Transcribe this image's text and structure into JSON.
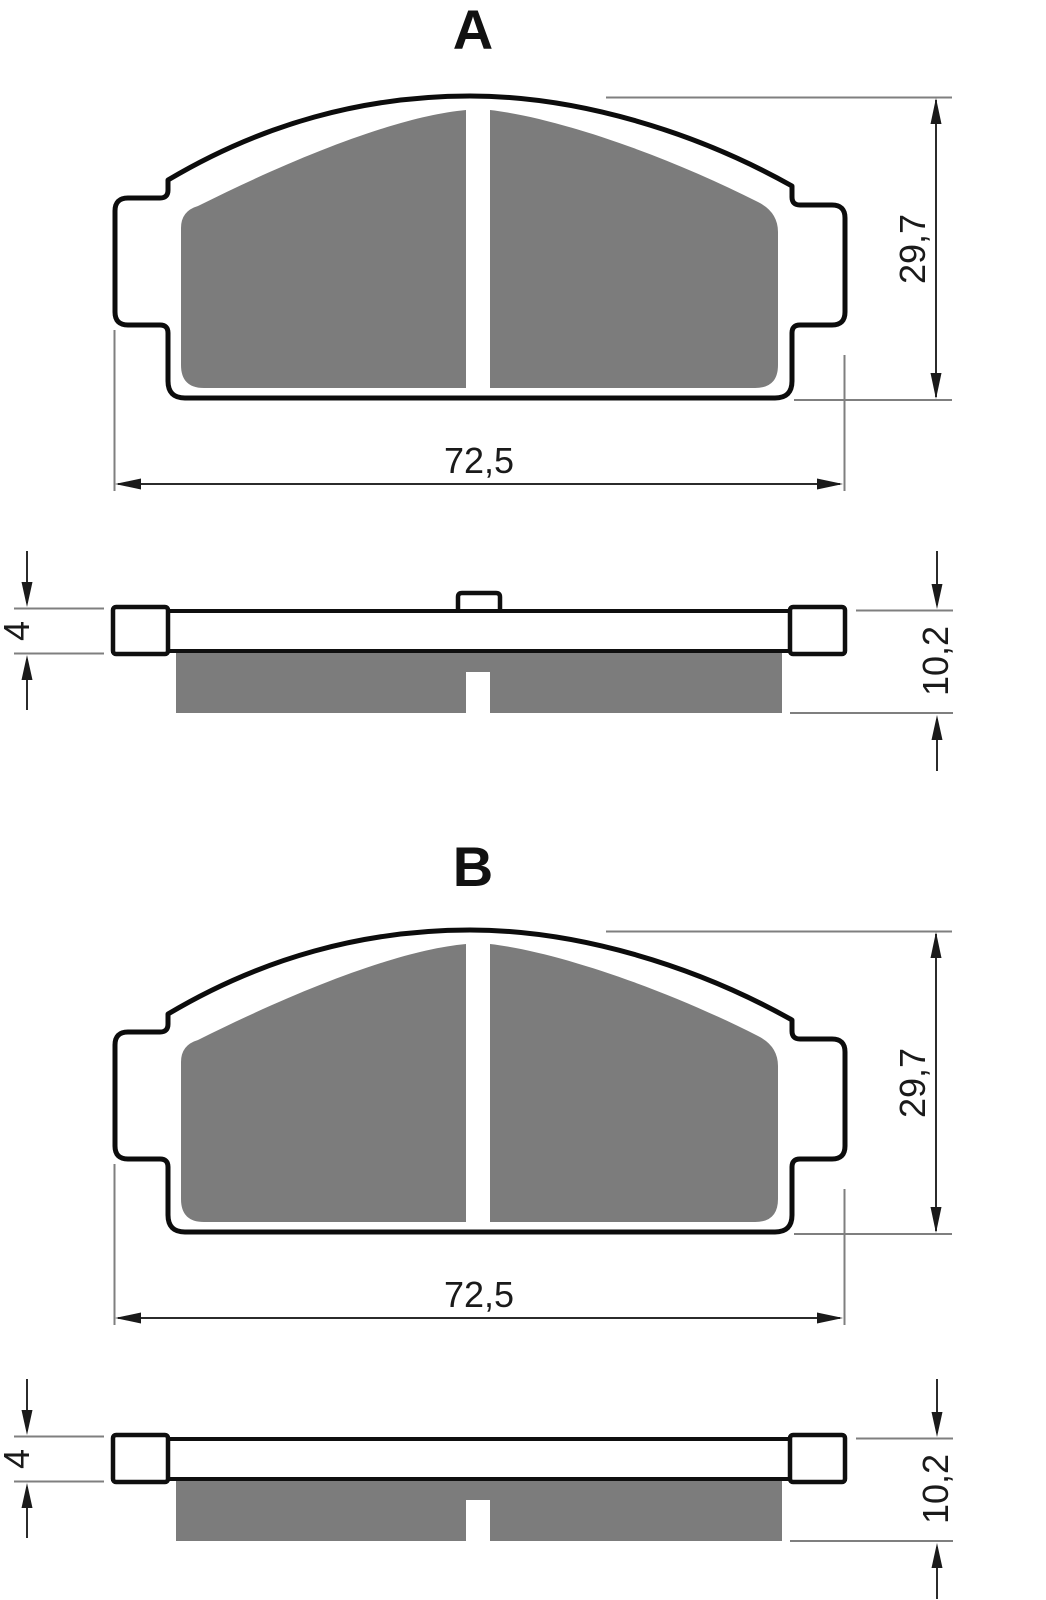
{
  "views": {
    "a": {
      "label": "A",
      "dimensions": {
        "width": "72,5",
        "height": "29,7",
        "backing_thickness": "4",
        "total_thickness": "10,2"
      }
    },
    "b": {
      "label": "B",
      "dimensions": {
        "width": "72,5",
        "height": "29,7",
        "backing_thickness": "4",
        "total_thickness": "10,2"
      }
    }
  },
  "colors": {
    "friction_material": "#7c7c7c",
    "outline": "#0c0c0c",
    "dimension_line": "#2b2b2b",
    "extension_line": "#7f7f7f",
    "background": "#ffffff"
  }
}
